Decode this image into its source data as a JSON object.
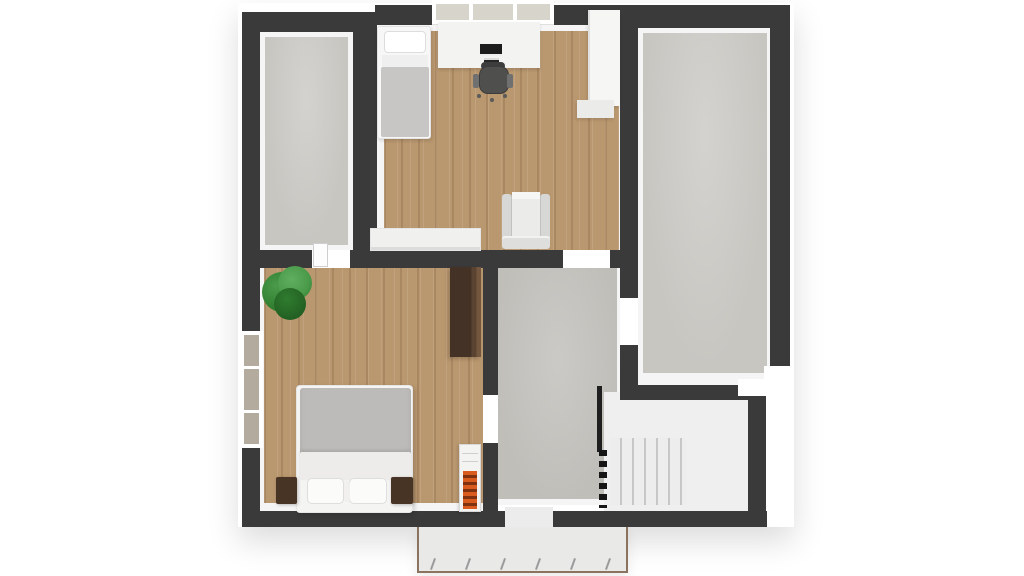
{
  "scene": {
    "type": "3d-floor-plan-top-view",
    "description": "Top-down 3D rendered floor plan of an upper storey with two attic storage rooms, a bedroom-office, a master bedroom, a hallway landing, a staircase and a balcony",
    "background": "#ffffff"
  },
  "colors": {
    "wall": "#3a3a3a",
    "trim": "#f5f5f5",
    "wood": "#b9976f",
    "concrete": "#c8c6c1",
    "concretedark": "#c0beb9",
    "stairfloor": "#efefef",
    "tread": "#c7c7c7",
    "balconyfloor": "#e9e9e8",
    "balconyedge": "#8a7460",
    "radorange": "#d95b1e",
    "raddark": "#7e3210",
    "duvet": "#bdbbb9",
    "blanket": "#c7c6c4",
    "whitefurn": "#f4f4f3",
    "armgray": "#d7d7d6",
    "chairdark": "#4f4f4e",
    "darkwood": "#4a3729",
    "glasstop": "#d7d4cc",
    "glassside": "#b3ab9e",
    "railing": "#161616",
    "plant1": "#2f7c2f",
    "plant2": "#4a9a4a",
    "plant3": "#236023"
  },
  "rooms": [
    {
      "id": "attic-storage-left",
      "label": "Attic storage room (left)"
    },
    {
      "id": "bedroom-office",
      "label": "Bedroom / office"
    },
    {
      "id": "attic-storage-right",
      "label": "Attic storage room (right)"
    },
    {
      "id": "master-bedroom",
      "label": "Master bedroom"
    },
    {
      "id": "hallway-landing",
      "label": "Hallway landing"
    },
    {
      "id": "staircase",
      "label": "Staircase"
    },
    {
      "id": "balcony",
      "label": "Balcony"
    }
  ],
  "furniture": [
    {
      "id": "single-bed",
      "label": "Single bed"
    },
    {
      "id": "desk",
      "label": "Desk with monitor"
    },
    {
      "id": "office-chair",
      "label": "Office chair"
    },
    {
      "id": "white-wardrobe",
      "label": "White wardrobe"
    },
    {
      "id": "armchair",
      "label": "Armchair"
    },
    {
      "id": "sideboard-shelf",
      "label": "Low white sideboard"
    },
    {
      "id": "plant",
      "label": "Potted plant"
    },
    {
      "id": "double-bed",
      "label": "Double bed"
    },
    {
      "id": "nightstand-left",
      "label": "Nightstand (left)"
    },
    {
      "id": "nightstand-right",
      "label": "Nightstand (right)"
    },
    {
      "id": "dark-wardrobe",
      "label": "Dark wood wardrobe"
    },
    {
      "id": "radiator",
      "label": "Radiator"
    },
    {
      "id": "stair-railing",
      "label": "Stair railing"
    }
  ],
  "openings": [
    {
      "id": "window-office-top",
      "label": "Window above desk"
    },
    {
      "id": "window-bedroom-left",
      "label": "Bedroom side window"
    },
    {
      "id": "window-corner-right",
      "label": "Corner window (right room)"
    },
    {
      "id": "door-storage-bedroom",
      "label": "Door: storage room to bedroom"
    },
    {
      "id": "opening-office-hall",
      "label": "Opening: office to hallway"
    },
    {
      "id": "door-hall-storage",
      "label": "Door: hallway to right storage"
    },
    {
      "id": "door-bedroom-hall",
      "label": "Door: bedroom to hallway"
    },
    {
      "id": "door-balcony",
      "label": "Balcony door"
    }
  ]
}
